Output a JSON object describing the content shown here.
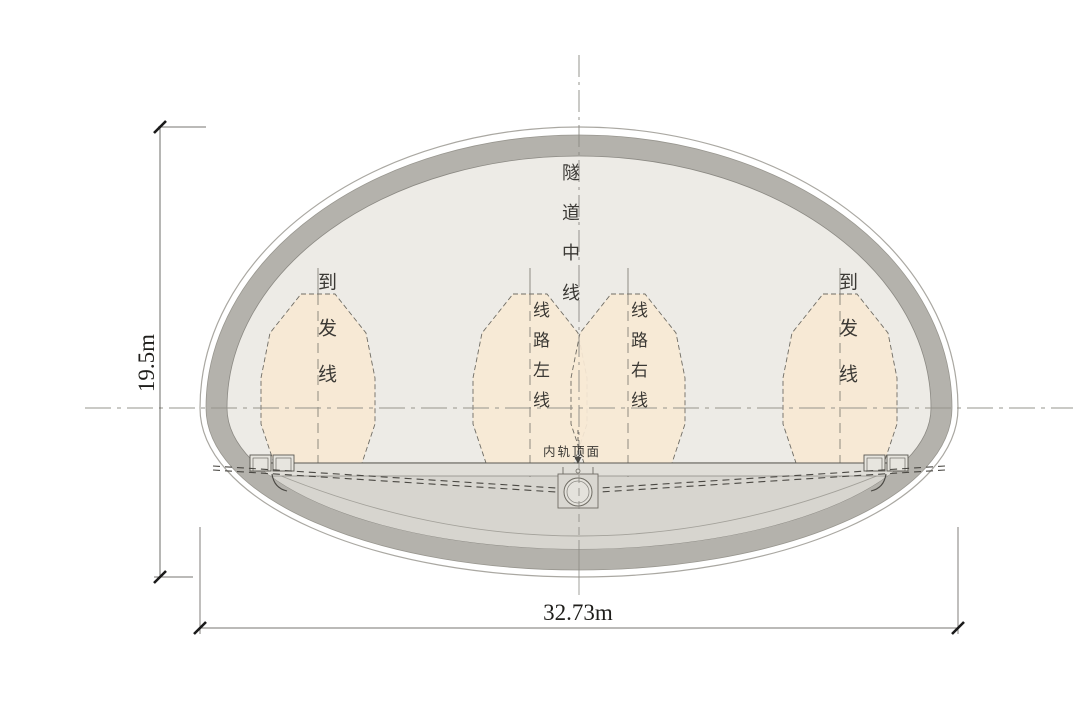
{
  "labels": {
    "tunnel_centerline": "隧道中线",
    "arrival_departure_left": "到发线",
    "line_left": "线路左线",
    "line_right": "线路右线",
    "arrival_departure_right": "到发线",
    "inner_rail_top": "内轨顶面"
  },
  "dimensions": {
    "height": "19.5m",
    "width": "32.73m"
  },
  "colors": {
    "lining_ring": "#b4b2ac",
    "interior": "#edebe6",
    "invert_fill": "#d7d5cf",
    "track_bed": "#e0ded8",
    "envelope_fill": "#f7e9d5",
    "outline_stroke": "#aaa8a2",
    "dark_line": "#4a4843",
    "center_line": "#9a988f",
    "text": "#3b3935"
  }
}
